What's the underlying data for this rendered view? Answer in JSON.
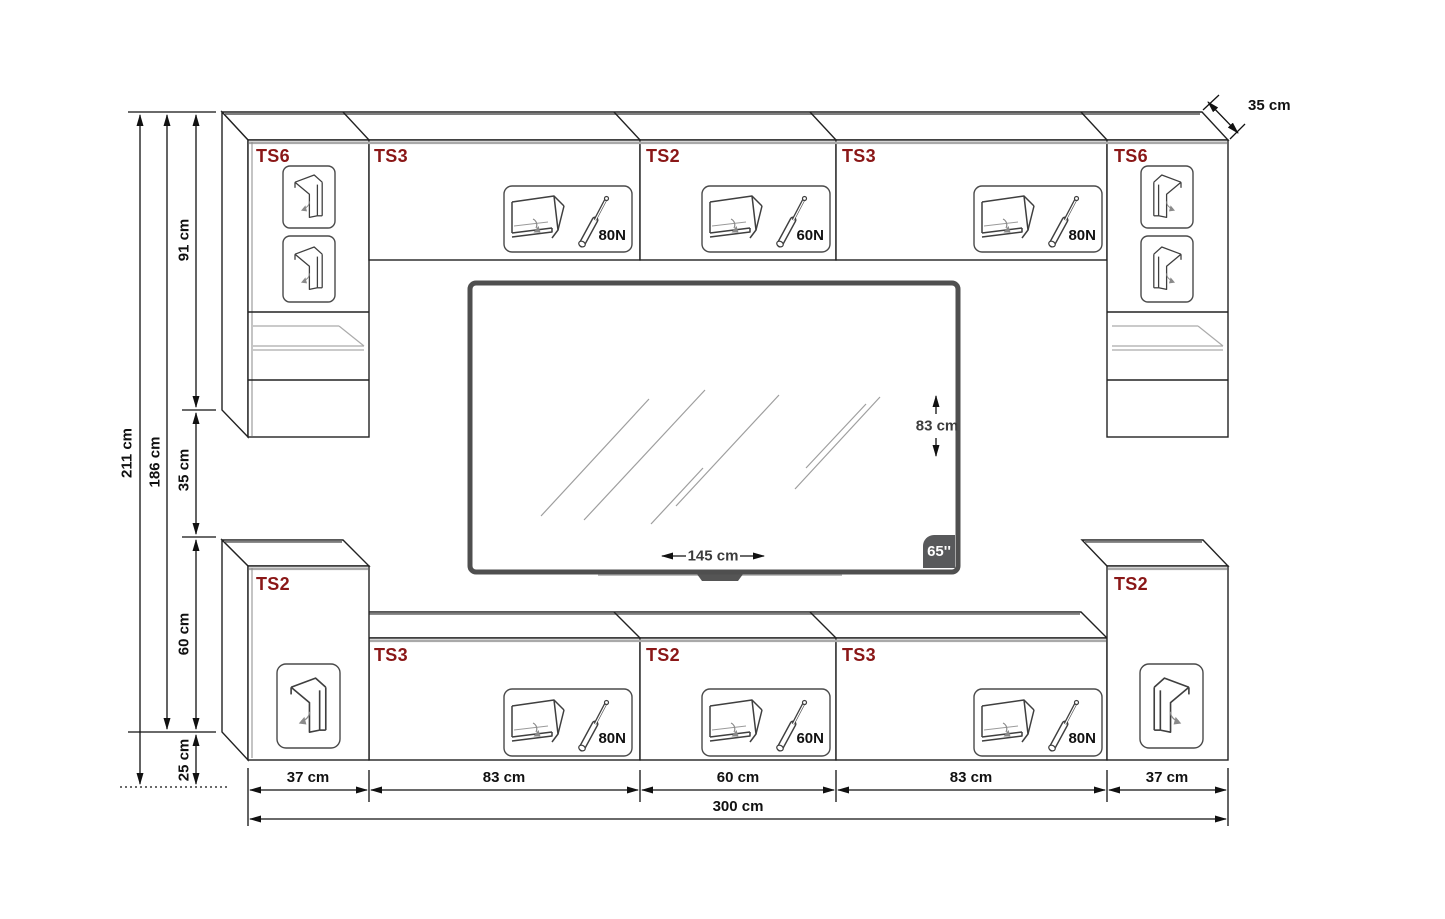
{
  "cabinets": {
    "top_row": [
      {
        "label": "TS6"
      },
      {
        "label": "TS3",
        "strut": "80N"
      },
      {
        "label": "TS2",
        "strut": "60N"
      },
      {
        "label": "TS3",
        "strut": "80N"
      },
      {
        "label": "TS6"
      }
    ],
    "bottom_row": [
      {
        "label": "TS2"
      },
      {
        "label": "TS3",
        "strut": "80N"
      },
      {
        "label": "TS2",
        "strut": "60N"
      },
      {
        "label": "TS3",
        "strut": "80N"
      },
      {
        "label": "TS2"
      }
    ]
  },
  "dimensions": {
    "left": {
      "total_height": "211 cm",
      "wall_unit_height": "186 cm",
      "upper_cabinet_height": "91 cm",
      "middle_gap": "35 cm",
      "lower_cabinet_height": "60 cm",
      "floor_clearance": "25 cm"
    },
    "depth": "35 cm",
    "bottom": {
      "segments": [
        "37 cm",
        "83 cm",
        "60 cm",
        "83 cm",
        "37 cm"
      ],
      "total_width": "300 cm"
    }
  },
  "tv": {
    "diagonal": "65''",
    "width": "145 cm",
    "height": "83 cm"
  },
  "colors": {
    "label_red": "#8a1717",
    "line": "#1f1f1f",
    "gray_edge": "#a9a9a9",
    "tv_frame": "#4f4f4f",
    "badge_gray": "#58595b"
  }
}
